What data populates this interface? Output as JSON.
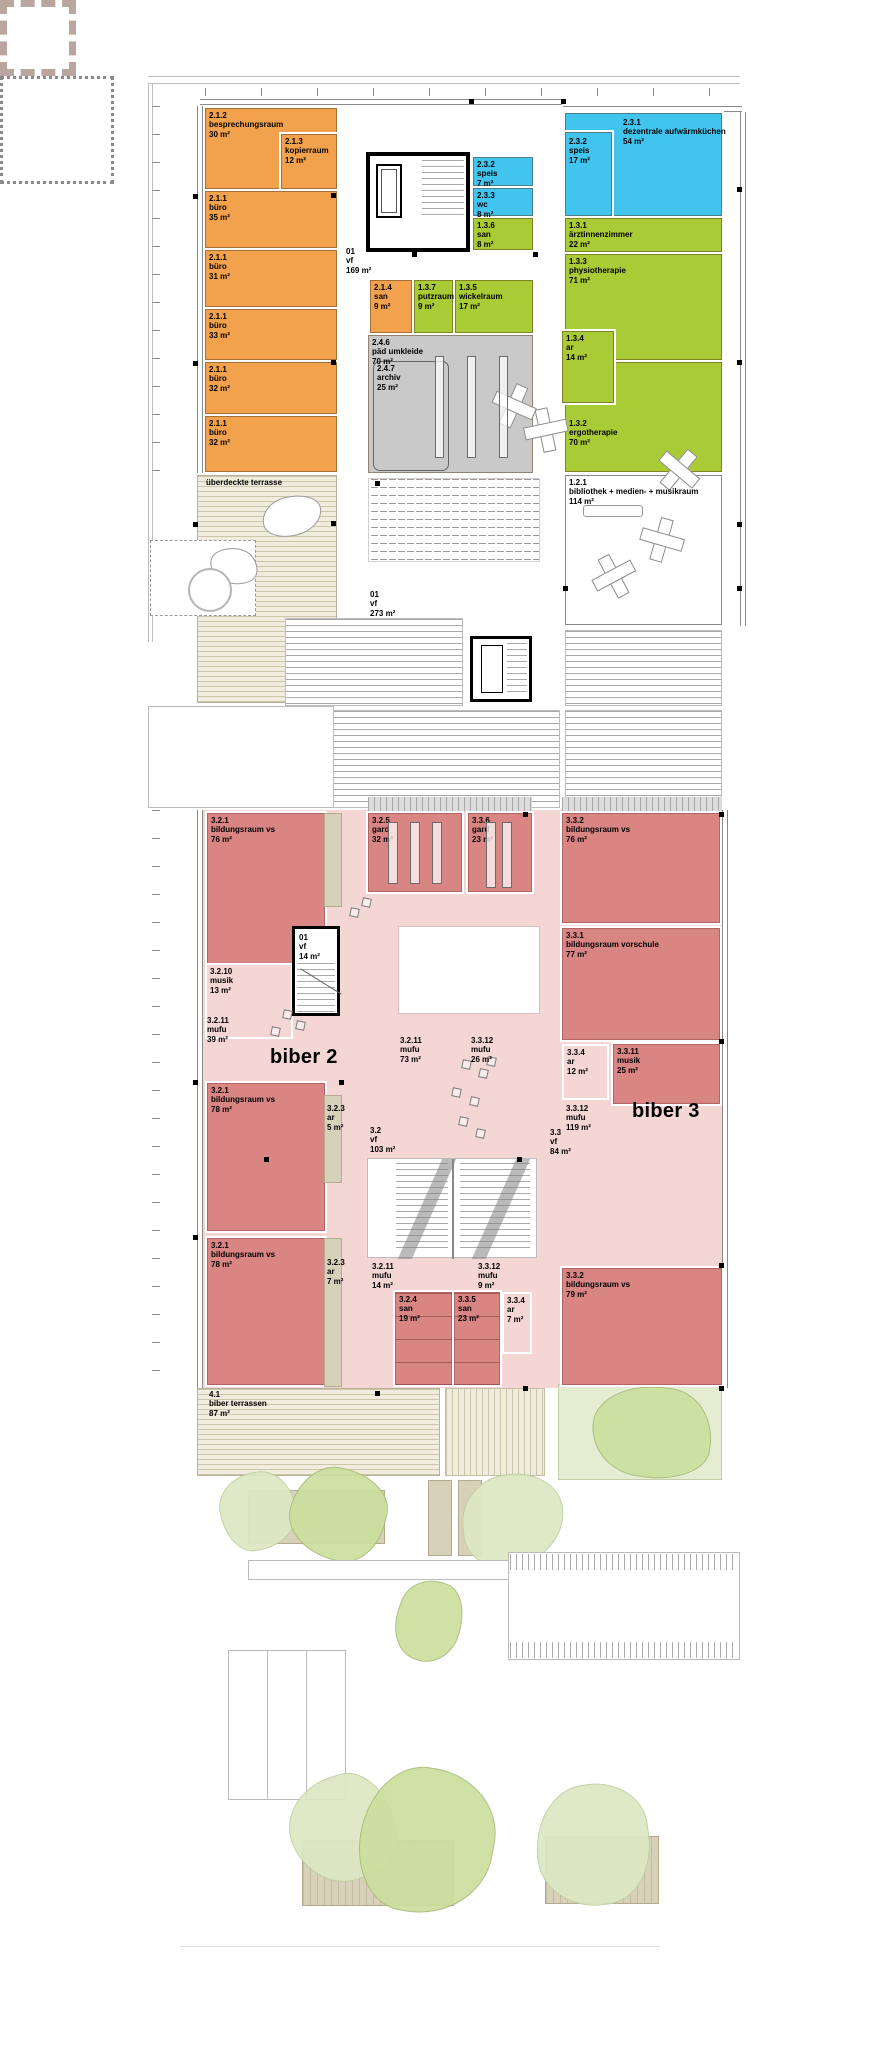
{
  "title": "obergeschoss grundriss – kindergarten biber 2 / biber 3",
  "colors": {
    "orange": "#F2A24C",
    "blue": "#41C4EE",
    "green": "#A9CB35",
    "gray": "#C9C9C9",
    "darkpink": "#D88583",
    "lightpink": "#F4D6D5",
    "beige": "#D8D1BA",
    "white": "#FFFFFF",
    "none": ""
  },
  "rooms": [
    {
      "id": "2.1.2",
      "name": "besprechungsraum",
      "area": "30 m²",
      "color": "orange",
      "x": 205,
      "y": 108,
      "w": 132,
      "h": 81
    },
    {
      "id": "2.1.3",
      "name": "kopierraum",
      "area": "12 m²",
      "color": "orange",
      "x": 281,
      "y": 134,
      "w": 56,
      "h": 55
    },
    {
      "id": "2.1.1",
      "name": "büro",
      "area": "35 m²",
      "color": "orange",
      "x": 205,
      "y": 191,
      "w": 132,
      "h": 57
    },
    {
      "id": "2.1.1",
      "name": "büro",
      "area": "31 m²",
      "color": "orange",
      "x": 205,
      "y": 250,
      "w": 132,
      "h": 57
    },
    {
      "id": "2.1.1",
      "name": "büro",
      "area": "33 m²",
      "color": "orange",
      "x": 205,
      "y": 309,
      "w": 132,
      "h": 51
    },
    {
      "id": "2.1.1",
      "name": "büro",
      "area": "32 m²",
      "color": "orange",
      "x": 205,
      "y": 362,
      "w": 132,
      "h": 52
    },
    {
      "id": "2.1.1",
      "name": "büro",
      "area": "32 m²",
      "color": "orange",
      "x": 205,
      "y": 416,
      "w": 132,
      "h": 56
    },
    {
      "id": "2.3.1",
      "name": "dezentrale aufwärmküchen",
      "area": "54 m²",
      "color": "blue",
      "x": 565,
      "y": 113,
      "w": 157,
      "h": 103,
      "lx": 57,
      "ly": 4
    },
    {
      "id": "2.3.2",
      "name": "speis",
      "area": "17 m²",
      "color": "blue",
      "x": 565,
      "y": 132,
      "w": 47,
      "h": 84,
      "lx": 3,
      "ly": 4
    },
    {
      "id": "2.3.2",
      "name": "speis",
      "area": "7 m²",
      "color": "blue",
      "x": 473,
      "y": 157,
      "w": 60,
      "h": 29
    },
    {
      "id": "2.3.3",
      "name": "wc",
      "area": "8 m²",
      "color": "blue",
      "x": 473,
      "y": 188,
      "w": 60,
      "h": 28
    },
    {
      "id": "1.3.6",
      "name": "san",
      "area": "8 m²",
      "color": "green",
      "x": 473,
      "y": 218,
      "w": 60,
      "h": 32
    },
    {
      "id": "1.3.1",
      "name": "ärztinnenzimmer",
      "area": "22 m²",
      "color": "green",
      "x": 565,
      "y": 218,
      "w": 157,
      "h": 34
    },
    {
      "id": "1.3.3",
      "name": "physiotherapie",
      "area": "71 m²",
      "color": "green",
      "x": 565,
      "y": 254,
      "w": 157,
      "h": 106
    },
    {
      "id": "1.3.2",
      "name": "ergotherapie",
      "area": "70 m²",
      "color": "green",
      "x": 565,
      "y": 362,
      "w": 157,
      "h": 110,
      "lx": 3,
      "ly": 56
    },
    {
      "id": "1.3.4",
      "name": "ar",
      "area": "14 m²",
      "color": "green",
      "x": 562,
      "y": 331,
      "w": 52,
      "h": 72
    },
    {
      "id": "2.1.4",
      "name": "san",
      "area": "9 m²",
      "color": "orange",
      "x": 370,
      "y": 280,
      "w": 42,
      "h": 53
    },
    {
      "id": "1.3.7",
      "name": "putzraum",
      "area": "9 m²",
      "color": "green",
      "x": 414,
      "y": 280,
      "w": 39,
      "h": 53
    },
    {
      "id": "1.3.5",
      "name": "wickelraum",
      "area": "17 m²",
      "color": "green",
      "x": 455,
      "y": 280,
      "w": 78,
      "h": 53
    },
    {
      "id": "2.4.6",
      "name": "päd umkleide",
      "area": "70 m²",
      "color": "gray",
      "x": 368,
      "y": 335,
      "w": 165,
      "h": 138
    },
    {
      "id": "2.4.7",
      "name": "archiv",
      "area": "25 m²",
      "color": "none",
      "cls": "outline-round",
      "x": 373,
      "y": 361,
      "w": 76,
      "h": 110
    },
    {
      "id": "1.2.1",
      "name": "bibliothek + medien- + musikraum",
      "area": "114 m²",
      "color": "white",
      "cls": "white-room",
      "x": 565,
      "y": 475,
      "w": 157,
      "h": 150
    },
    {
      "id": "3.2.1",
      "name": "bildungsraum vs",
      "area": "76 m²",
      "color": "darkpink",
      "x": 207,
      "y": 813,
      "w": 118,
      "h": 152
    },
    {
      "id": "3.2.5",
      "name": "gard",
      "area": "32 m²",
      "color": "darkpink",
      "x": 368,
      "y": 813,
      "w": 94,
      "h": 79
    },
    {
      "id": "3.3.6",
      "name": "gard",
      "area": "23 m²",
      "color": "darkpink",
      "x": 468,
      "y": 813,
      "w": 64,
      "h": 79
    },
    {
      "id": "3.3.2",
      "name": "bildungsraum vs",
      "area": "76 m²",
      "color": "darkpink",
      "x": 562,
      "y": 813,
      "w": 158,
      "h": 110
    },
    {
      "id": "3.3.1",
      "name": "bildungsraum vorschule",
      "area": "77 m²",
      "color": "darkpink",
      "x": 562,
      "y": 928,
      "w": 158,
      "h": 112
    },
    {
      "id": "3.2.10",
      "name": "musik",
      "area": "13 m²",
      "color": "lightpink",
      "cls": "zone",
      "x": 205,
      "y": 963,
      "w": 88,
      "h": 76
    },
    {
      "id": "3.3.4",
      "name": "ar",
      "area": "12 m²",
      "color": "lightpink",
      "cls": "zone",
      "x": 562,
      "y": 1044,
      "w": 47,
      "h": 56
    },
    {
      "id": "3.3.11",
      "name": "musik",
      "area": "25 m²",
      "color": "darkpink",
      "x": 613,
      "y": 1044,
      "w": 107,
      "h": 60
    },
    {
      "id": "3.2.1",
      "name": "bildungsraum vs",
      "area": "78 m²",
      "color": "darkpink",
      "x": 207,
      "y": 1083,
      "w": 118,
      "h": 148
    },
    {
      "id": "3.2.1",
      "name": "bildungsraum vs",
      "area": "78 m²",
      "color": "darkpink",
      "x": 207,
      "y": 1238,
      "w": 118,
      "h": 147
    },
    {
      "id": "3.2.4",
      "name": "san",
      "area": "19 m²",
      "color": "darkpink",
      "cls": "fixtures",
      "x": 395,
      "y": 1292,
      "w": 57,
      "h": 93
    },
    {
      "id": "3.3.5",
      "name": "san",
      "area": "23 m²",
      "color": "darkpink",
      "cls": "fixtures",
      "x": 454,
      "y": 1292,
      "w": 46,
      "h": 93
    },
    {
      "id": "3.3.4",
      "name": "ar",
      "area": "7 m²",
      "color": "lightpink",
      "cls": "zone",
      "x": 502,
      "y": 1292,
      "w": 30,
      "h": 62
    },
    {
      "id": "3.3.2",
      "name": "bildungsraum vs",
      "area": "79 m²",
      "color": "darkpink",
      "x": 562,
      "y": 1268,
      "w": 160,
      "h": 117
    }
  ],
  "labels": [
    {
      "lines": [
        "01",
        "vf",
        "169 m²"
      ],
      "x": 346,
      "y": 247
    },
    {
      "lines": [
        "01",
        "vf",
        "273 m²"
      ],
      "x": 370,
      "y": 590
    },
    {
      "lines": [
        "überdeckte terrasse"
      ],
      "x": 206,
      "y": 478
    },
    {
      "lines": [
        "01",
        "vf",
        "14 m²"
      ],
      "x": 299,
      "y": 933
    },
    {
      "lines": [
        "3.2.11",
        "mufu",
        "39 m²"
      ],
      "x": 207,
      "y": 1016
    },
    {
      "lines": [
        "3.2.11",
        "mufu",
        "73 m²"
      ],
      "x": 400,
      "y": 1036
    },
    {
      "lines": [
        "3.3.12",
        "mufu",
        "26 m²"
      ],
      "x": 471,
      "y": 1036
    },
    {
      "lines": [
        "3.3.12",
        "mufu",
        "119 m²"
      ],
      "x": 566,
      "y": 1104
    },
    {
      "lines": [
        "3.2",
        "vf",
        "103 m²"
      ],
      "x": 370,
      "y": 1126
    },
    {
      "lines": [
        "3.3",
        "vf",
        "84 m²"
      ],
      "x": 550,
      "y": 1128
    },
    {
      "lines": [
        "3.2.3",
        "ar",
        "5 m²"
      ],
      "x": 327,
      "y": 1104
    },
    {
      "lines": [
        "3.2.3",
        "ar",
        "7 m²"
      ],
      "x": 327,
      "y": 1258
    },
    {
      "lines": [
        "3.2.11",
        "mufu",
        "14 m²"
      ],
      "x": 372,
      "y": 1262
    },
    {
      "lines": [
        "3.3.12",
        "mufu",
        "9 m²"
      ],
      "x": 478,
      "y": 1262
    },
    {
      "lines": [
        "4.1",
        "biber terrassen",
        "87 m²"
      ],
      "x": 209,
      "y": 1390
    }
  ],
  "big_labels": [
    {
      "text": "biber 2",
      "x": 270,
      "y": 1046
    },
    {
      "text": "biber 3",
      "x": 632,
      "y": 1100
    }
  ],
  "markers": [
    [
      193,
      194
    ],
    [
      193,
      361
    ],
    [
      193,
      522
    ],
    [
      331,
      193
    ],
    [
      331,
      360
    ],
    [
      331,
      521
    ],
    [
      469,
      99
    ],
    [
      561,
      99
    ],
    [
      737,
      187
    ],
    [
      737,
      360
    ],
    [
      737,
      522
    ],
    [
      412,
      252
    ],
    [
      533,
      252
    ],
    [
      563,
      586
    ],
    [
      737,
      586
    ],
    [
      375,
      481
    ],
    [
      193,
      1080
    ],
    [
      193,
      1235
    ],
    [
      339,
      1080
    ],
    [
      523,
      812
    ],
    [
      719,
      812
    ],
    [
      719,
      1039
    ],
    [
      719,
      1263
    ],
    [
      523,
      1386
    ],
    [
      719,
      1386
    ],
    [
      264,
      1157
    ],
    [
      517,
      1157
    ],
    [
      375,
      1391
    ]
  ]
}
